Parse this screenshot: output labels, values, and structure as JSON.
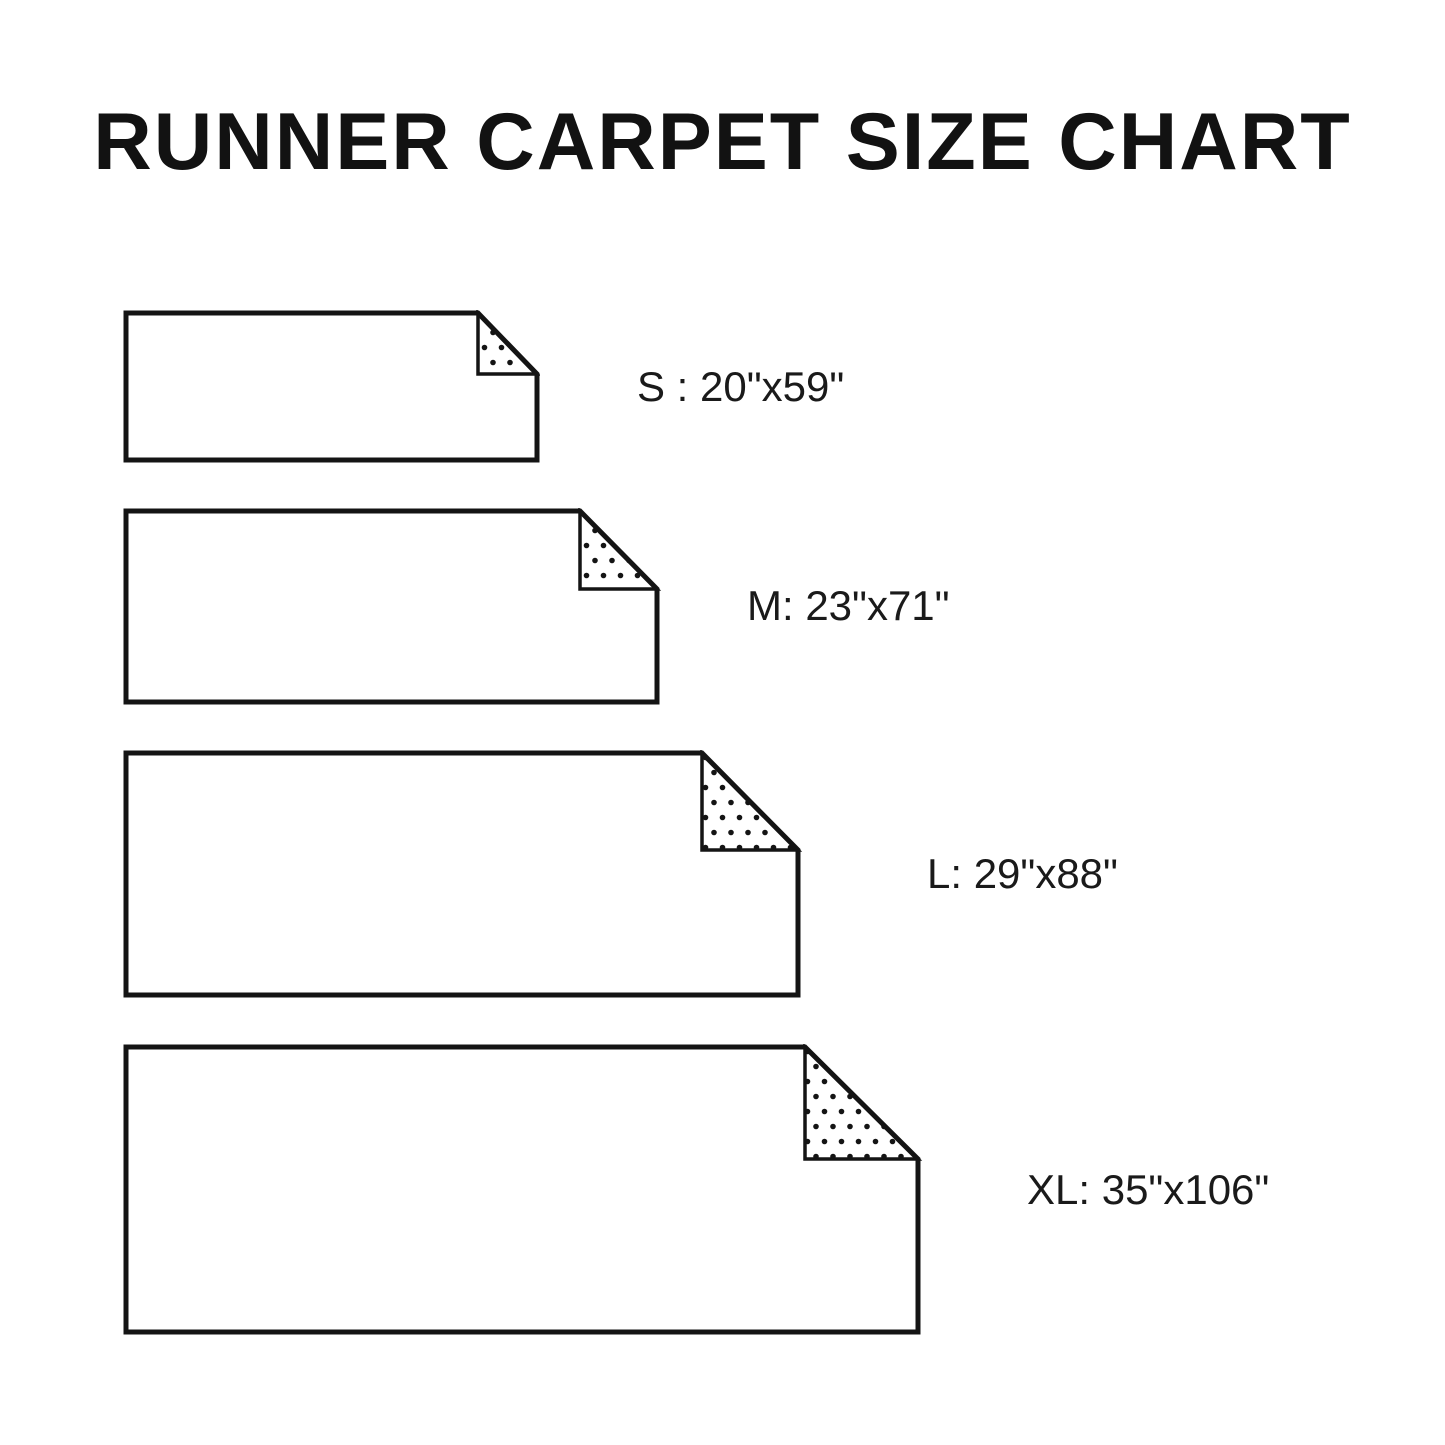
{
  "title": "RUNNER CARPET SIZE CHART",
  "sizes": [
    {
      "id": "S",
      "label": "S : 20\"x59\"",
      "width_in": 20,
      "length_in": 59
    },
    {
      "id": "M",
      "label": "M: 23\"x71\"",
      "width_in": 23,
      "length_in": 71
    },
    {
      "id": "L",
      "label": "L: 29\"x88\"",
      "width_in": 29,
      "length_in": 88
    },
    {
      "id": "XL",
      "label": "XL: 35\"x106\"",
      "width_in": 35,
      "length_in": 106
    }
  ],
  "colors": {
    "background": "#ffffff",
    "line": "#141414",
    "dot": "#141414",
    "text": "#1a1a1a"
  }
}
